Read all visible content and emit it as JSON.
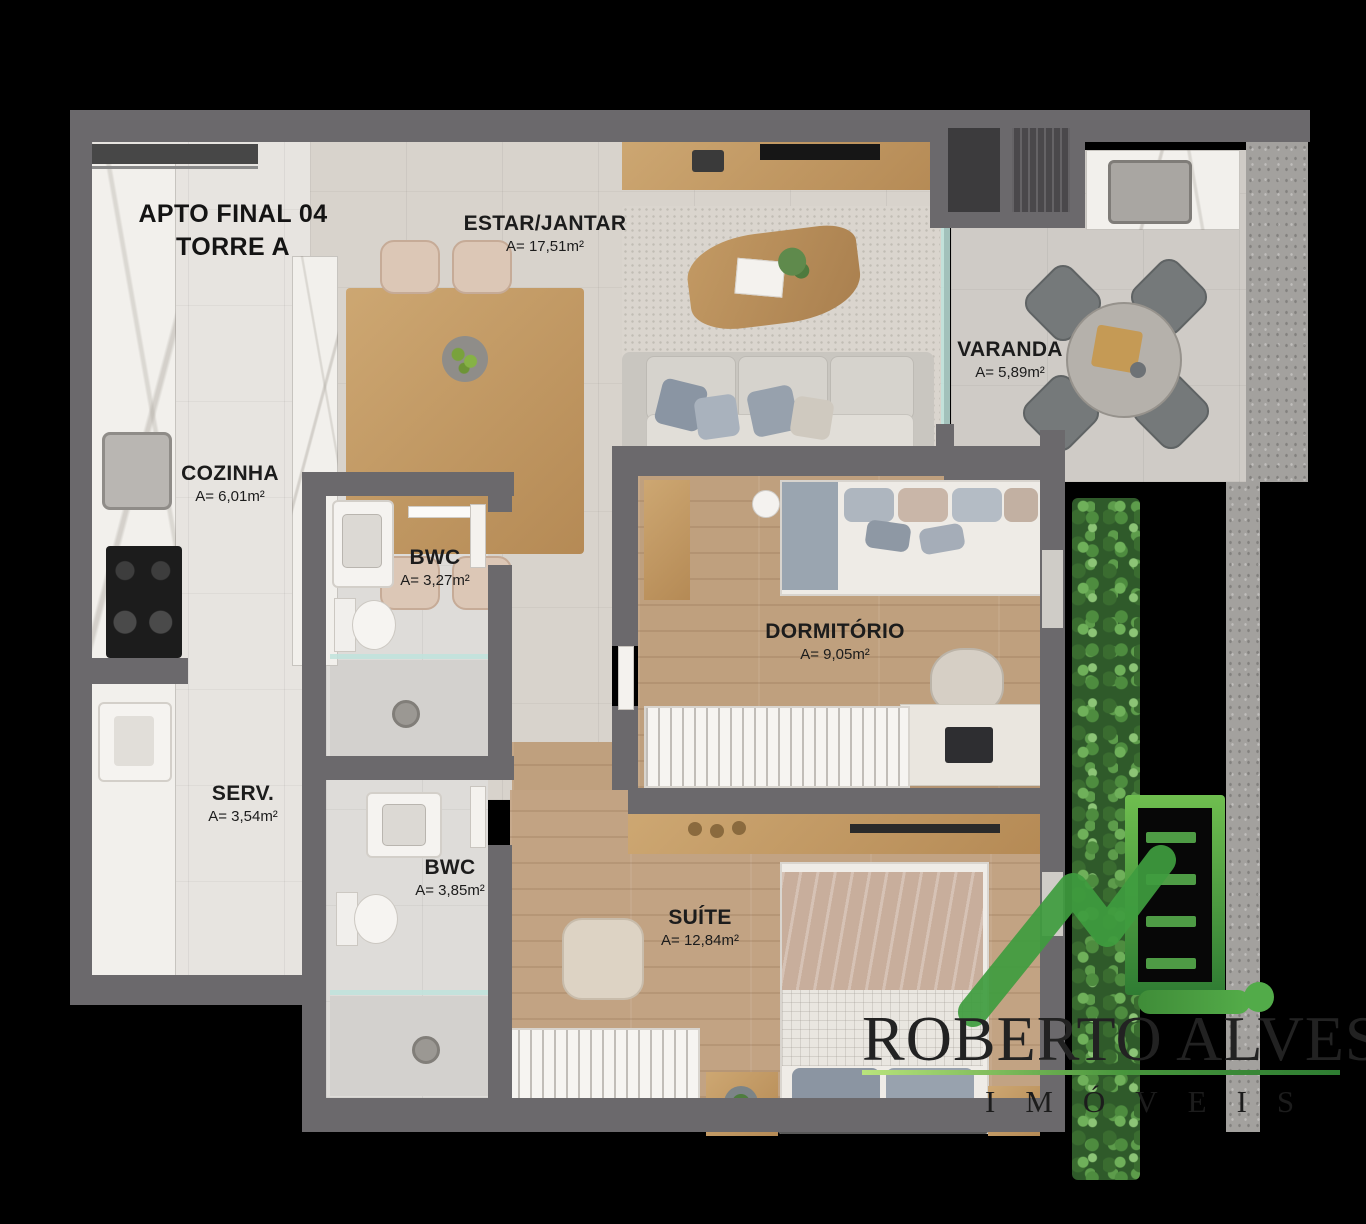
{
  "title": {
    "line1": "APTO FINAL 04",
    "line2": "TORRE A"
  },
  "rooms": [
    {
      "name": "ESTAR/JANTAR",
      "area": "A= 17,51m²"
    },
    {
      "name": "VARANDA",
      "area": "A= 5,89m²"
    },
    {
      "name": "COZINHA",
      "area": "A= 6,01m²"
    },
    {
      "name": "BWC",
      "area": "A= 3,27m²"
    },
    {
      "name": "DORMITÓRIO",
      "area": "A= 9,05m²"
    },
    {
      "name": "SERV.",
      "area": "A= 3,54m²"
    },
    {
      "name": "BWC",
      "area": "A= 3,85m²"
    },
    {
      "name": "SUÍTE",
      "area": "A= 12,84m²"
    }
  ],
  "watermark": {
    "brand": "ROBERTO ALVES",
    "subtitle": "IMÓVEIS"
  },
  "colors": {
    "background": "#000000",
    "wall_gray": "#6b696c",
    "wood_floor": "#bfa07e",
    "brand_green": "#3f9d3f"
  }
}
